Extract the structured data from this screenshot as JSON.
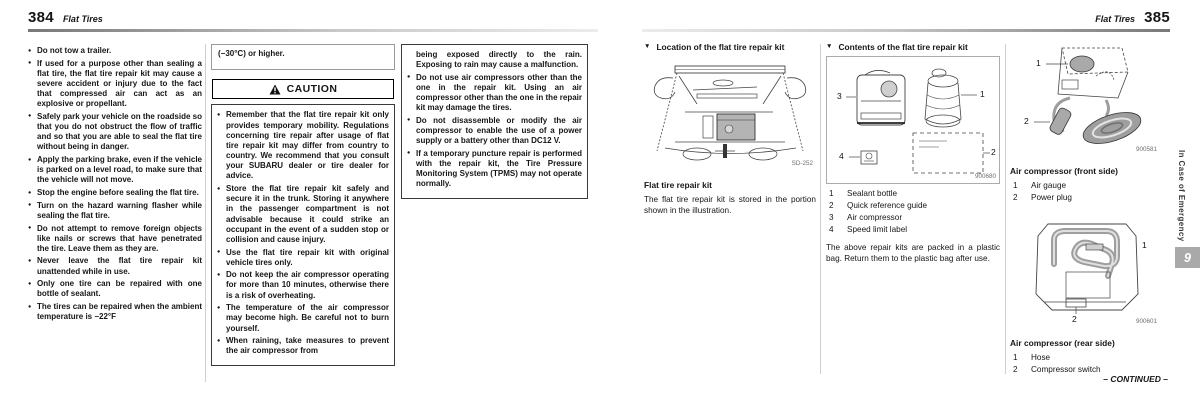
{
  "ui": {
    "section_marker": "▼"
  },
  "page_left": {
    "page_number": "384",
    "header_title": "Flat Tires",
    "warnings_col1": [
      "Do not tow a trailer.",
      "If used for a purpose other than sealing a flat tire, the flat tire repair kit may cause a severe accident or injury due to the fact that compressed air can act as an explosive or propellant.",
      "Safely park your vehicle on the roadside so that you do not obstruct the flow of traffic and so that you are able to seal the flat tire without being in danger.",
      "Apply the parking brake, even if the vehicle is parked on a level road, to make sure that the vehicle will not move.",
      "Stop the engine before sealing the flat tire.",
      "Turn on the hazard warning flasher while sealing the flat tire.",
      "Do not attempt to remove foreign objects like nails or screws that have penetrated the tire. Leave them as they are.",
      "Never leave the flat tire repair kit unattended while in use.",
      "Only one tire can be repaired with one bottle of sealant.",
      "The tires can be repaired when the ambient temperature is −22°F"
    ],
    "temp_continuation": "(−30°C) or higher.",
    "caution": {
      "title": "CAUTION",
      "bullets_col2": [
        "Remember that the flat tire repair kit only provides temporary mobility. Regulations concerning tire repair after usage of flat tire repair kit may differ from country to country. We recommend that you consult your SUBARU dealer or tire dealer for advice.",
        "Store the flat tire repair kit safely and secure it in the trunk. Storing it anywhere in the passenger compartment is not advisable because it could strike an occupant in the event of a sudden stop or collision and cause injury.",
        "Use the flat tire repair kit with original vehicle tires only.",
        "Do not keep the air compressor operating for more than 10 minutes, otherwise there is a risk of overheating.",
        "The temperature of the air compressor may become high. Be careful not to burn yourself.",
        "When raining, take measures to prevent the air compressor from"
      ],
      "continuation_col3": "being exposed directly to the rain. Exposing to rain may cause a malfunction.",
      "bullets_col3": [
        "Do not use air compressors other than the one in the repair kit. Using an air compressor other than the one in the repair kit may damage the tires.",
        "Do not disassemble or modify the air compressor to enable the use of a power supply or a battery other than DC12 V.",
        "If a temporary puncture repair is performed with the repair kit, the Tire Pressure Monitoring System (TPMS) may not operate normally."
      ]
    }
  },
  "page_right": {
    "page_number": "385",
    "header_title": "Flat Tires",
    "location_section": {
      "title": "Location of the flat tire repair kit",
      "figure_code": "SD-252",
      "caption": "Flat tire repair kit",
      "body": "The flat tire repair kit is stored in the portion shown in the illustration."
    },
    "contents_section": {
      "title": "Contents of the flat tire repair kit",
      "figure_code": "900680",
      "items": [
        {
          "num": "1",
          "label": "Sealant bottle"
        },
        {
          "num": "2",
          "label": "Quick reference guide"
        },
        {
          "num": "3",
          "label": "Air compressor"
        },
        {
          "num": "4",
          "label": "Speed limit label"
        }
      ],
      "body": "The above repair kits are packed in a plastic bag. Return them to the plastic bag after use."
    },
    "compressor_front": {
      "caption": "Air compressor (front side)",
      "figure_code": "900581",
      "items": [
        {
          "num": "1",
          "label": "Air gauge"
        },
        {
          "num": "2",
          "label": "Power plug"
        }
      ]
    },
    "compressor_rear": {
      "caption": "Air compressor (rear side)",
      "figure_code": "900601",
      "items": [
        {
          "num": "1",
          "label": "Hose"
        },
        {
          "num": "2",
          "label": "Compressor switch"
        }
      ]
    },
    "sidebar": {
      "chapter_title": "In Case of Emergency",
      "chapter_number": "9"
    },
    "continued_label": "– CONTINUED –"
  }
}
